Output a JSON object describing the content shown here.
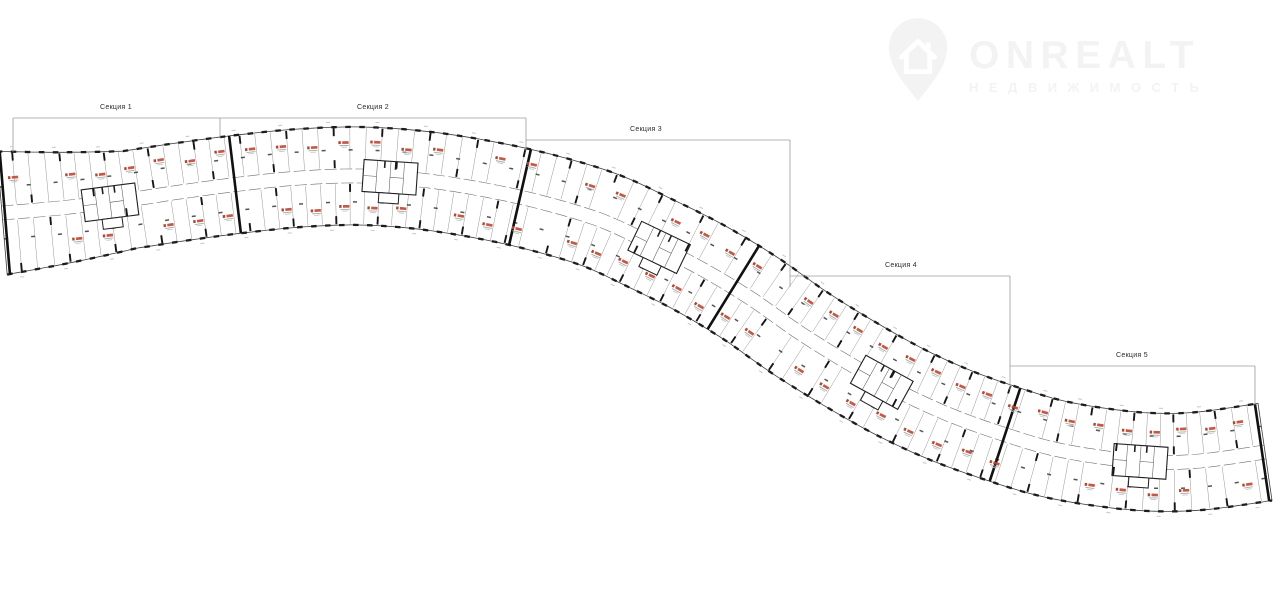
{
  "page": {
    "background": "#ffffff"
  },
  "logo": {
    "brand": "ONREALT",
    "subtitle": "НЕДВИЖИМОСТЬ",
    "color": "#f3f3f3",
    "icon": "house-pin-icon"
  },
  "plan": {
    "sections": [
      {
        "label": "Секция 1"
      },
      {
        "label": "Секция 2"
      },
      {
        "label": "Секция 3"
      },
      {
        "label": "Секция 4"
      },
      {
        "label": "Секция 5"
      }
    ],
    "colors": {
      "walls": "#1d1d1d",
      "partitions": "#8a8a8a",
      "apartment_marker": "#b8432f",
      "bracket": "#9c9c9c",
      "dimension_text": "#c7c7c7"
    }
  }
}
